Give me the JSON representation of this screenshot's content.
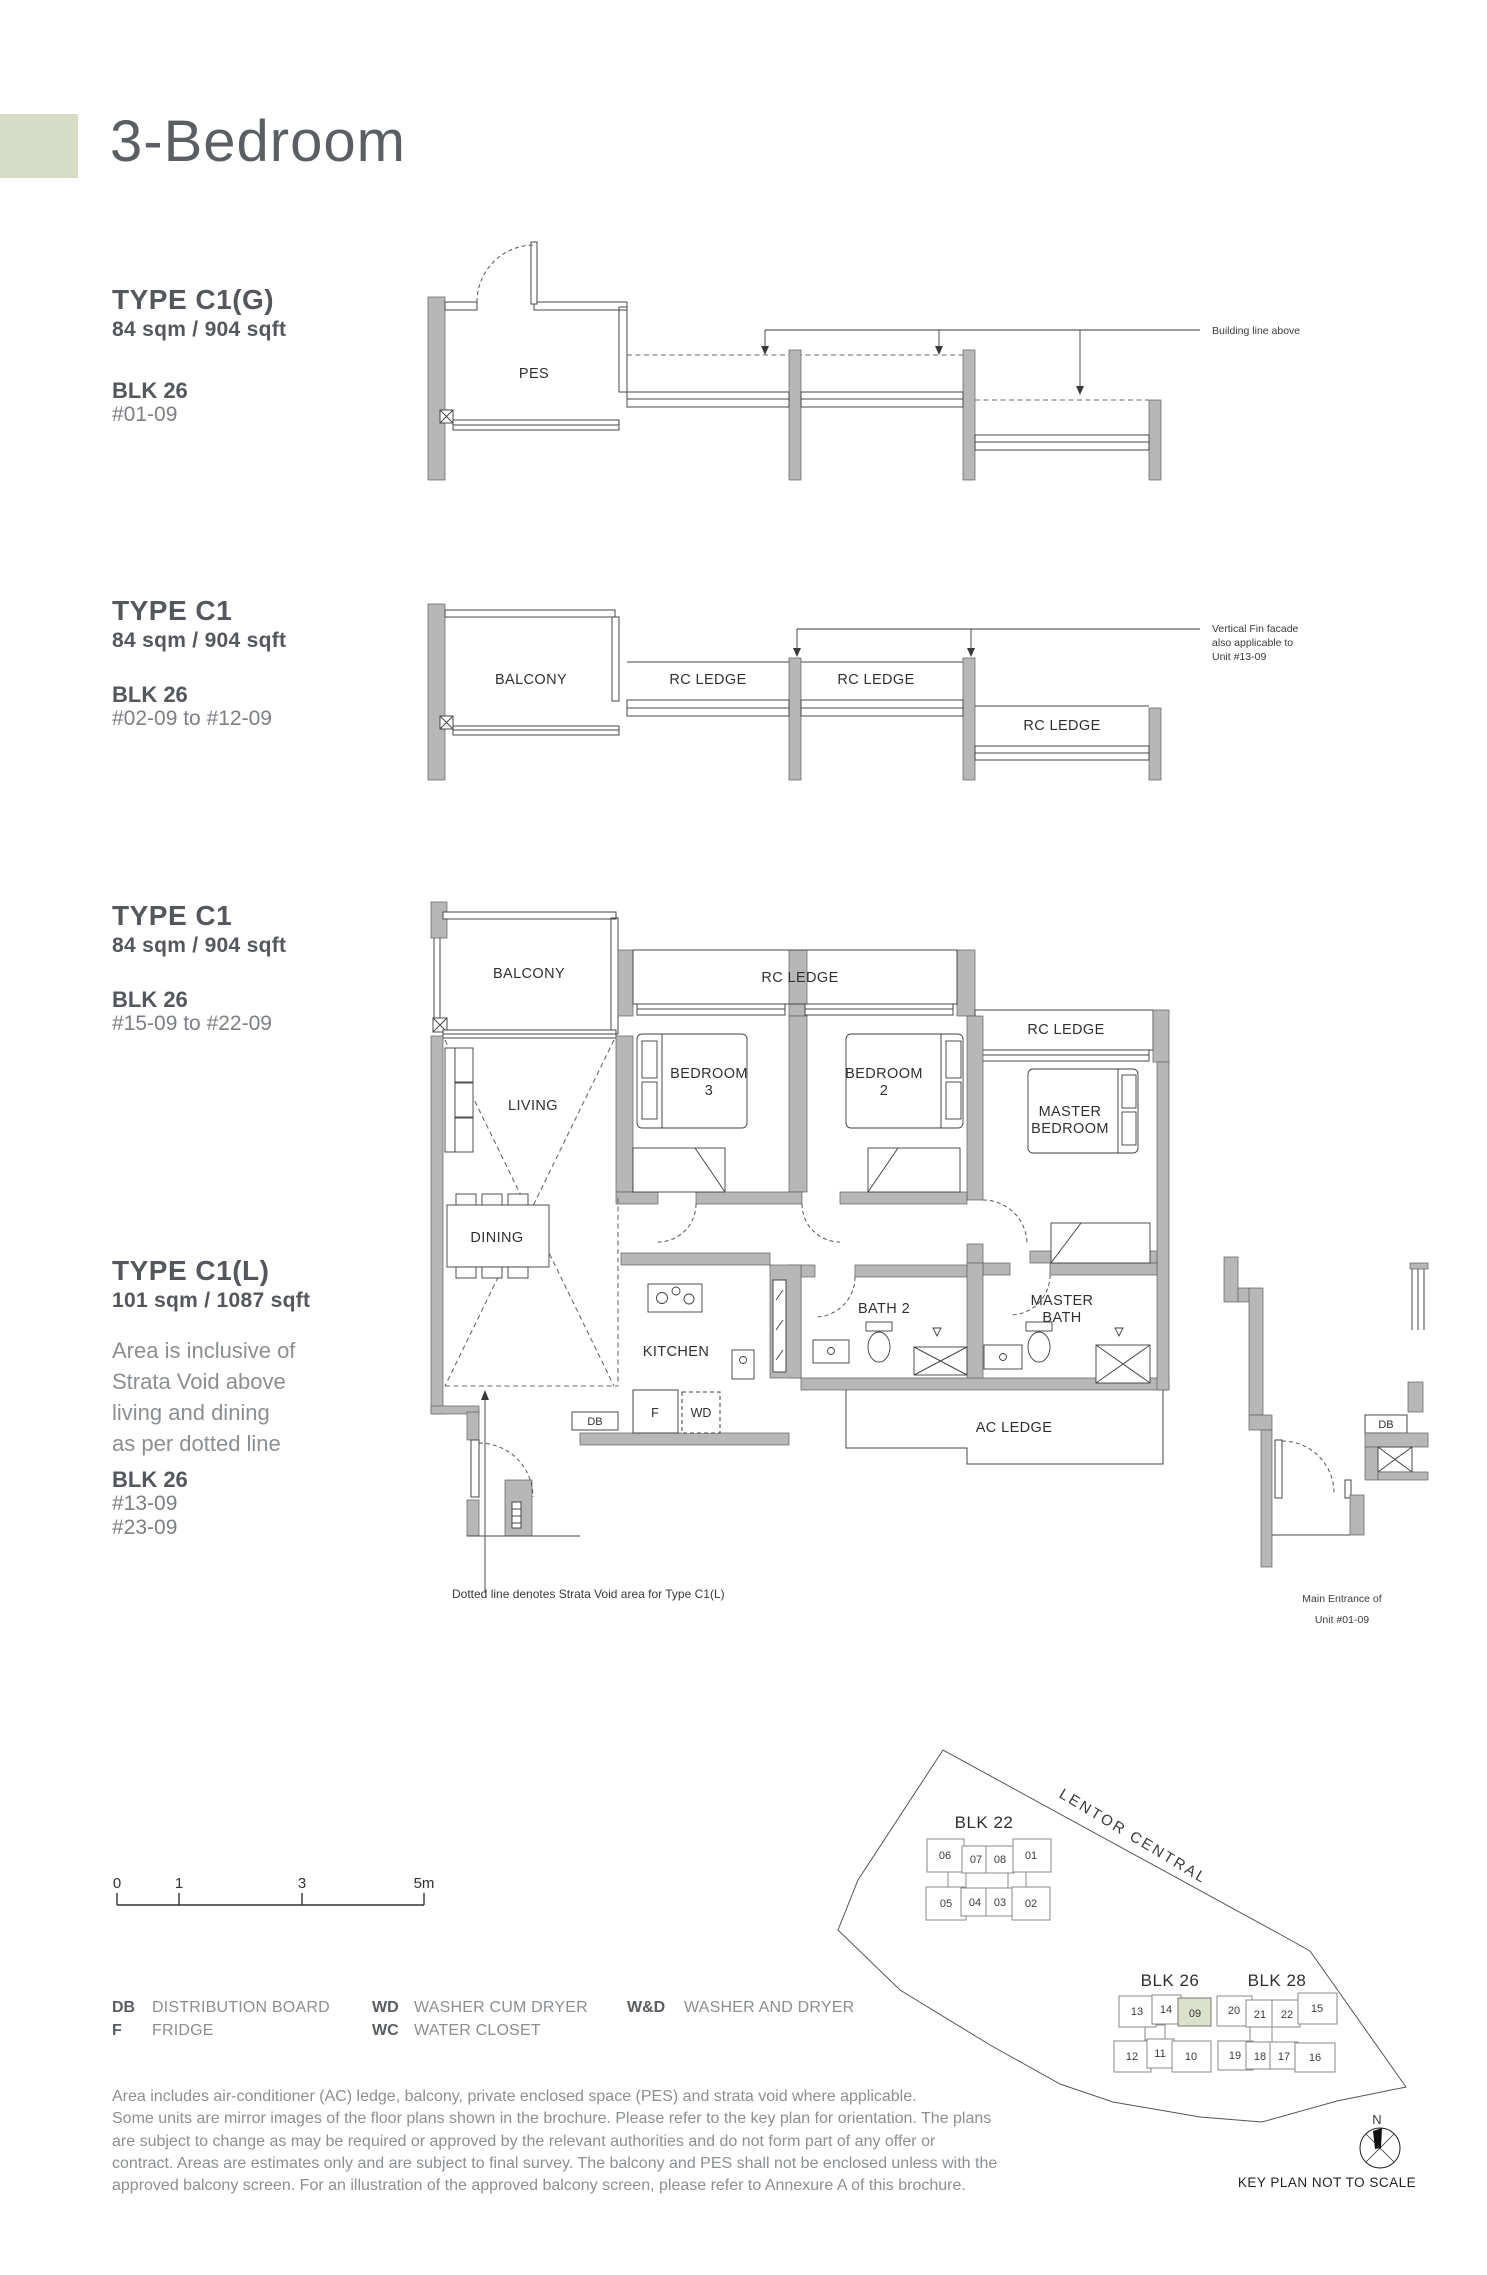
{
  "page": {
    "title": "3-Bedroom",
    "accent_color": "#d7dcc6",
    "heading_color": "#54575b",
    "light_text_color": "#8b8f92"
  },
  "types": {
    "c1g": {
      "name": "TYPE C1(G)",
      "area": "84 sqm / 904 sqft",
      "blk": "BLK 26",
      "units": "#01-09"
    },
    "c1a": {
      "name": "TYPE C1",
      "area": "84 sqm / 904 sqft",
      "blk": "BLK 26",
      "units": "#02-09 to #12-09"
    },
    "c1b": {
      "name": "TYPE C1",
      "area": "84 sqm / 904 sqft",
      "blk": "BLK 26",
      "units": "#15-09 to #22-09"
    },
    "c1l": {
      "name": "TYPE C1(L)",
      "area": "101 sqm / 1087 sqft",
      "note_lines": [
        "Area is inclusive of",
        "Strata Void above",
        "living and dining",
        "as per dotted line"
      ],
      "blk": "BLK 26",
      "units1": "#13-09",
      "units2": "#23-09"
    }
  },
  "plan_labels": {
    "pes": "PES",
    "balcony": "BALCONY",
    "rc_ledge": "RC LEDGE",
    "living": "LIVING",
    "dining": "DINING",
    "kitchen": "KITCHEN",
    "bedroom": "BEDROOM",
    "bedroom3_num": "3",
    "bedroom2_num": "2",
    "master": "MASTER",
    "master_bedroom_word": "BEDROOM",
    "bath2": "BATH 2",
    "master_bath_word": "BATH",
    "ac_ledge": "AC LEDGE",
    "db": "DB",
    "fridge": "F",
    "wd": "WD"
  },
  "annotations": {
    "building_line": "Building line above",
    "fin_line1": "Vertical Fin facade",
    "fin_line2": "also applicable to",
    "fin_line3": "Unit #13-09",
    "strata_note": "Dotted line denotes Strata Void area for Type C1(L)",
    "entrance_line1": "Main Entrance of",
    "entrance_line2": "Unit #01-09"
  },
  "scale": {
    "ticks": [
      "0",
      "1",
      "3",
      "5m"
    ]
  },
  "legend": {
    "col1": [
      {
        "abbr": "DB",
        "label": "DISTRIBUTION BOARD"
      },
      {
        "abbr": "F",
        "label": "FRIDGE"
      }
    ],
    "col2": [
      {
        "abbr": "WD",
        "label": "WASHER CUM DRYER"
      },
      {
        "abbr": "WC",
        "label": "WATER CLOSET"
      }
    ],
    "col3": [
      {
        "abbr": "W&D",
        "label": "WASHER AND DRYER"
      }
    ]
  },
  "disclaimer_lines": [
    "Area includes air-conditioner (AC) ledge, balcony, private enclosed space (PES) and strata void where applicable.",
    "Some units are mirror images of the floor plans shown in the brochure. Please refer to the key plan for orientation. The plans",
    "are subject to change as may be required or approved by the relevant authorities and do not form part of any offer or",
    "contract. Areas are estimates only and are subject to final survey. The balcony and PES shall not be enclosed unless with the",
    "approved balcony screen. For an illustration of the approved balcony screen, please refer to Annexure A of this brochure."
  ],
  "keyplan": {
    "road": "LENTOR CENTRAL",
    "north": "N",
    "caption": "KEY PLAN NOT TO SCALE",
    "highlight_color": "#dbe1ca",
    "highlighted_unit": "09",
    "blk22": {
      "label": "BLK 22",
      "top": [
        "06",
        "07",
        "08",
        "01"
      ],
      "bottom": [
        "05",
        "04",
        "03",
        "02"
      ]
    },
    "blk26": {
      "label": "BLK 26",
      "top": [
        "13",
        "14",
        "09"
      ],
      "bottom": [
        "12",
        "11",
        "10"
      ]
    },
    "blk28": {
      "label": "BLK 28",
      "top": [
        "20",
        "21",
        "22",
        "15"
      ],
      "bottom": [
        "19",
        "18",
        "17",
        "16"
      ]
    }
  }
}
